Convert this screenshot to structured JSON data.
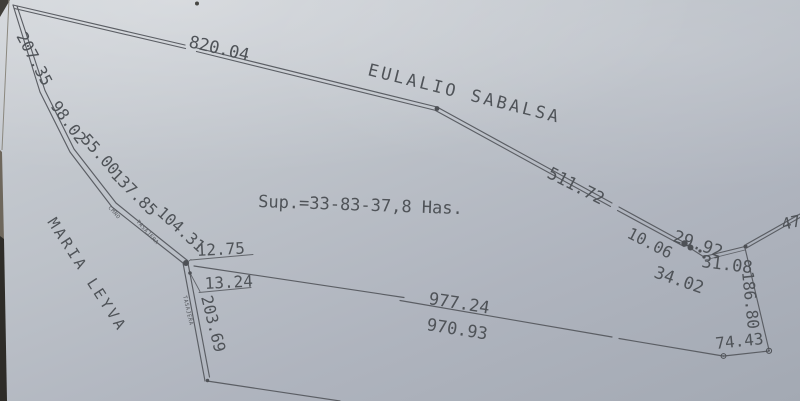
{
  "parcel": {
    "area_text": "Sup.=33-83-37,8 Has.",
    "adjoiner_north": "EULALIO SABALSA",
    "adjoiner_west": "MARIA LEYVA",
    "road_label_word1": "CMNO",
    "road_label_word2": "TASAJERA",
    "road_label_lower": "TASAJERA"
  },
  "measurements": {
    "top_boundary": "820.04",
    "west_1": "207.35",
    "west_2": "98.02",
    "west_3": "55.00",
    "west_4": "137.85",
    "west_5": "104.31",
    "jog_upper": "12.75",
    "jog_lower": "13.24",
    "west_lower": "203.69",
    "northeast_diagonal": "511.72",
    "corner_a": "10.06",
    "corner_b": "29.92",
    "corner_c": "34.02",
    "corner_d": "31.08",
    "northeast_partial": "47",
    "east_boundary": "186.80",
    "southeast": "74.43",
    "south_upper": "977.24",
    "south_lower": "970.93"
  }
}
